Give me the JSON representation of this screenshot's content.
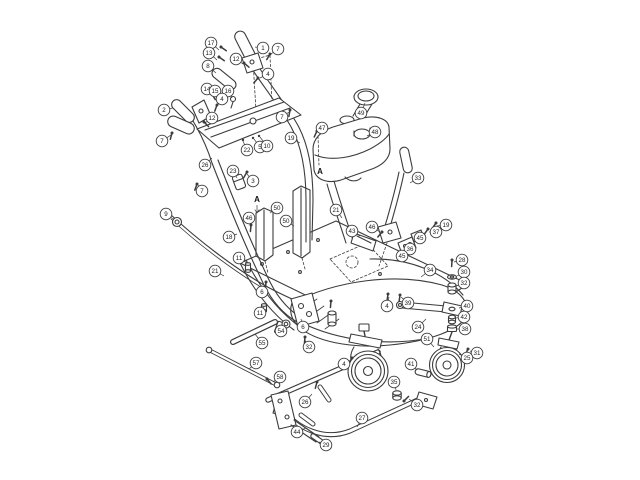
{
  "diagram": {
    "canvas": {
      "width": 640,
      "height": 480,
      "background": "#ffffff",
      "line_color": "#3c3c3c",
      "balloon_fill": "#ffffff",
      "balloon_stroke": "#3c3c3c"
    },
    "callouts": [
      {
        "label": "17",
        "x": 211,
        "y": 43,
        "tx": 219,
        "ty": 50
      },
      {
        "label": "13",
        "x": 209,
        "y": 53,
        "tx": 217,
        "ty": 60
      },
      {
        "label": "8",
        "x": 208,
        "y": 66,
        "tx": 216,
        "ty": 73
      },
      {
        "label": "1",
        "x": 263,
        "y": 48,
        "tx": 255,
        "ty": 47
      },
      {
        "label": "7",
        "x": 278,
        "y": 49,
        "tx": 271,
        "ty": 54
      },
      {
        "label": "12",
        "x": 236,
        "y": 59,
        "tx": 243,
        "ty": 64
      },
      {
        "label": "4",
        "x": 268,
        "y": 74,
        "tx": 260,
        "ty": 78
      },
      {
        "label": "14",
        "x": 207,
        "y": 89,
        "tx": 213,
        "ty": 95
      },
      {
        "label": "15",
        "x": 215,
        "y": 91,
        "tx": 219,
        "ty": 97
      },
      {
        "label": "16",
        "x": 228,
        "y": 91,
        "tx": 232,
        "ty": 98
      },
      {
        "label": "4",
        "x": 222,
        "y": 99,
        "tx": 217,
        "ty": 105
      },
      {
        "label": "2",
        "x": 164,
        "y": 110,
        "tx": 173,
        "ty": 108
      },
      {
        "label": "12",
        "x": 212,
        "y": 118,
        "tx": 205,
        "ty": 123
      },
      {
        "label": "7",
        "x": 162,
        "y": 141,
        "tx": 171,
        "ty": 135
      },
      {
        "label": "7",
        "x": 282,
        "y": 117,
        "tx": 289,
        "ty": 112
      },
      {
        "label": "19",
        "x": 291,
        "y": 138,
        "tx": 300,
        "ty": 143
      },
      {
        "label": "22",
        "x": 247,
        "y": 150,
        "tx": 243,
        "ty": 141
      },
      {
        "label": "5",
        "x": 260,
        "y": 147,
        "tx": 254,
        "ty": 139
      },
      {
        "label": "10",
        "x": 267,
        "y": 146,
        "tx": 260,
        "ty": 137
      },
      {
        "label": "26",
        "x": 205,
        "y": 165,
        "tx": 212,
        "ty": 158
      },
      {
        "label": "23",
        "x": 233,
        "y": 171,
        "tx": 237,
        "ty": 178
      },
      {
        "label": "3",
        "x": 253,
        "y": 181,
        "tx": 247,
        "ty": 174
      },
      {
        "label": "7",
        "x": 202,
        "y": 191,
        "tx": 198,
        "ty": 185
      },
      {
        "label": "9",
        "x": 166,
        "y": 214,
        "tx": 173,
        "ty": 219
      },
      {
        "label": "50",
        "x": 277,
        "y": 208,
        "tx": 270,
        "ty": 213
      },
      {
        "label": "46",
        "x": 249,
        "y": 218,
        "tx": 251,
        "ty": 225
      },
      {
        "label": "50",
        "x": 286,
        "y": 221,
        "tx": 294,
        "ty": 226
      },
      {
        "label": "18",
        "x": 229,
        "y": 237,
        "tx": 237,
        "ty": 234
      },
      {
        "label": "11",
        "x": 239,
        "y": 258,
        "tx": 247,
        "ty": 263
      },
      {
        "label": "21",
        "x": 215,
        "y": 271,
        "tx": 224,
        "ty": 276
      },
      {
        "label": "6",
        "x": 262,
        "y": 292,
        "tx": 266,
        "ty": 284
      },
      {
        "label": "47",
        "x": 322,
        "y": 128,
        "tx": 318,
        "ty": 132
      },
      {
        "label": "49",
        "x": 361,
        "y": 113,
        "tx": 365,
        "ty": 103
      },
      {
        "label": "48",
        "x": 375,
        "y": 132,
        "tx": 367,
        "ty": 136
      },
      {
        "label": "33",
        "x": 418,
        "y": 178,
        "tx": 410,
        "ty": 183
      },
      {
        "label": "21",
        "x": 336,
        "y": 210,
        "tx": 342,
        "ty": 218
      },
      {
        "label": "43",
        "x": 352,
        "y": 231,
        "tx": 360,
        "ty": 236
      },
      {
        "label": "46",
        "x": 372,
        "y": 227,
        "tx": 380,
        "ty": 232
      },
      {
        "label": "19",
        "x": 446,
        "y": 225,
        "tx": 437,
        "ty": 226
      },
      {
        "label": "37",
        "x": 436,
        "y": 232,
        "tx": 429,
        "ty": 232
      },
      {
        "label": "45",
        "x": 420,
        "y": 238,
        "tx": 414,
        "ty": 240
      },
      {
        "label": "36",
        "x": 410,
        "y": 249,
        "tx": 404,
        "ty": 248
      },
      {
        "label": "45",
        "x": 402,
        "y": 256,
        "tx": 397,
        "ty": 253
      },
      {
        "label": "28",
        "x": 462,
        "y": 260,
        "tx": 454,
        "ty": 262
      },
      {
        "label": "30",
        "x": 464,
        "y": 272,
        "tx": 457,
        "ty": 276
      },
      {
        "label": "32",
        "x": 464,
        "y": 283,
        "tx": 456,
        "ty": 286
      },
      {
        "label": "34",
        "x": 430,
        "y": 270,
        "tx": 421,
        "ty": 277
      },
      {
        "label": "40",
        "x": 467,
        "y": 306,
        "tx": 459,
        "ty": 308
      },
      {
        "label": "42",
        "x": 464,
        "y": 317,
        "tx": 456,
        "ty": 318
      },
      {
        "label": "38",
        "x": 465,
        "y": 329,
        "tx": 457,
        "ty": 329
      },
      {
        "label": "24",
        "x": 418,
        "y": 327,
        "tx": 426,
        "ty": 319
      },
      {
        "label": "51",
        "x": 427,
        "y": 339,
        "tx": 434,
        "ty": 347
      },
      {
        "label": "31",
        "x": 477,
        "y": 353,
        "tx": 470,
        "ty": 351
      },
      {
        "label": "25",
        "x": 467,
        "y": 358,
        "tx": 459,
        "ty": 354
      },
      {
        "label": "41",
        "x": 411,
        "y": 364,
        "tx": 417,
        "ty": 370
      },
      {
        "label": "39",
        "x": 408,
        "y": 303,
        "tx": 401,
        "ty": 297
      },
      {
        "label": "4",
        "x": 387,
        "y": 306,
        "tx": 389,
        "ty": 297
      },
      {
        "label": "35",
        "x": 394,
        "y": 382,
        "tx": 396,
        "ty": 390
      },
      {
        "label": "32",
        "x": 417,
        "y": 405,
        "tx": 409,
        "ty": 399
      },
      {
        "label": "27",
        "x": 362,
        "y": 418,
        "tx": 357,
        "ty": 427
      },
      {
        "label": "26",
        "x": 305,
        "y": 402,
        "tx": 312,
        "ty": 394
      },
      {
        "label": "44",
        "x": 297,
        "y": 432,
        "tx": 306,
        "ty": 428
      },
      {
        "label": "29",
        "x": 326,
        "y": 445,
        "tx": 319,
        "ty": 442
      },
      {
        "label": "57",
        "x": 256,
        "y": 363,
        "tx": 249,
        "ty": 369
      },
      {
        "label": "58",
        "x": 280,
        "y": 377,
        "tx": 273,
        "ty": 382
      },
      {
        "label": "55",
        "x": 262,
        "y": 343,
        "tx": 255,
        "ty": 334
      },
      {
        "label": "54",
        "x": 281,
        "y": 331,
        "tx": 282,
        "ty": 327
      },
      {
        "label": "11",
        "x": 260,
        "y": 313,
        "tx": 264,
        "ty": 307
      },
      {
        "label": "6",
        "x": 303,
        "y": 327,
        "tx": 301,
        "ty": 319
      },
      {
        "label": "32",
        "x": 309,
        "y": 347,
        "tx": 305,
        "ty": 340
      },
      {
        "label": "4",
        "x": 344,
        "y": 364,
        "tx": 351,
        "ty": 360
      }
    ],
    "reference_labels": [
      {
        "label": "A",
        "x": 320,
        "y": 174,
        "arrow": false
      },
      {
        "label": "A",
        "x": 257,
        "y": 202,
        "arrow": true
      }
    ]
  }
}
